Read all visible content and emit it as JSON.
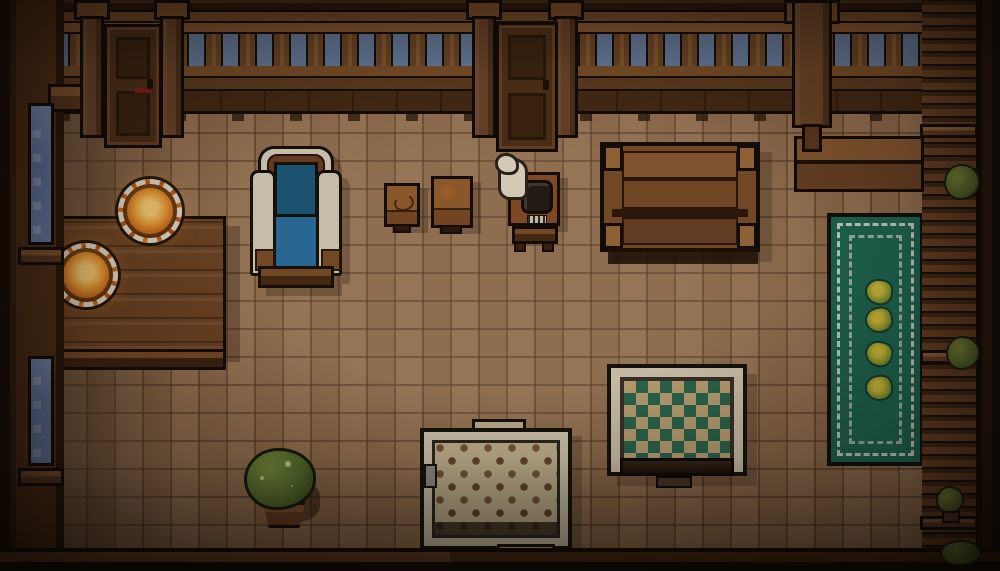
{
  "scene": {
    "type": "pixel-art top-down room interior",
    "setting": "wooden tavern room at dusk"
  },
  "palette": {
    "floor_tile": "#97714f",
    "floor_grout": "#6e4e36",
    "wall_wood_dark": "#3f2817",
    "wall_wood_mid": "#6b4425",
    "wall_wood_light": "#8a5a31",
    "sky": "#687e9f",
    "window_glass": "#7288b5",
    "door_wood": "#4e3018",
    "counter_wood": "#6f4524",
    "plate_rim": "#e9e0cc",
    "food_glow": "#f2a135",
    "chair_fabric_dark": "#1d5a7d",
    "chair_fabric_light": "#2a6fa0",
    "chair_trim": "#d9d0bd",
    "rug_green_field": "#1d6a54",
    "rug_green_trim": "#cfd8d2",
    "rug_check_field": "#c4a97a",
    "rug_check_diamond": "#2c6b50",
    "rug_dot_field": "#cfbf99",
    "rug_dot_brown": "#6b4a33",
    "plant_green": "#5a7430",
    "pot_brown": "#6b3f22",
    "steam_white": "#e9dfc8",
    "bench_wood": "#7c4f29"
  },
  "entities": {
    "architecture": [
      "top-wall-with-balustrade",
      "sky-gaps-between-balusters",
      "left-door",
      "center-door",
      "support-posts",
      "left-wall-two-windows",
      "right-wall-shelves",
      "bottom-wall",
      "tiled-floor"
    ],
    "furniture": [
      "wooden-counter-table",
      "two-plates-with-glowing-food",
      "blue-armchair",
      "small-crate",
      "large-crate",
      "stove-table-with-kettle-and-steam",
      "wooden-bench",
      "top-right-ledge"
    ],
    "rugs": [
      "green-runner-rug-with-four-flowers",
      "diamond-pattern-rug",
      "dotted-rug"
    ],
    "plants": [
      "potted-plant",
      "shelf-bush-upper",
      "shelf-bush-middle",
      "shelf-plant-lower",
      "corner-bush"
    ]
  }
}
